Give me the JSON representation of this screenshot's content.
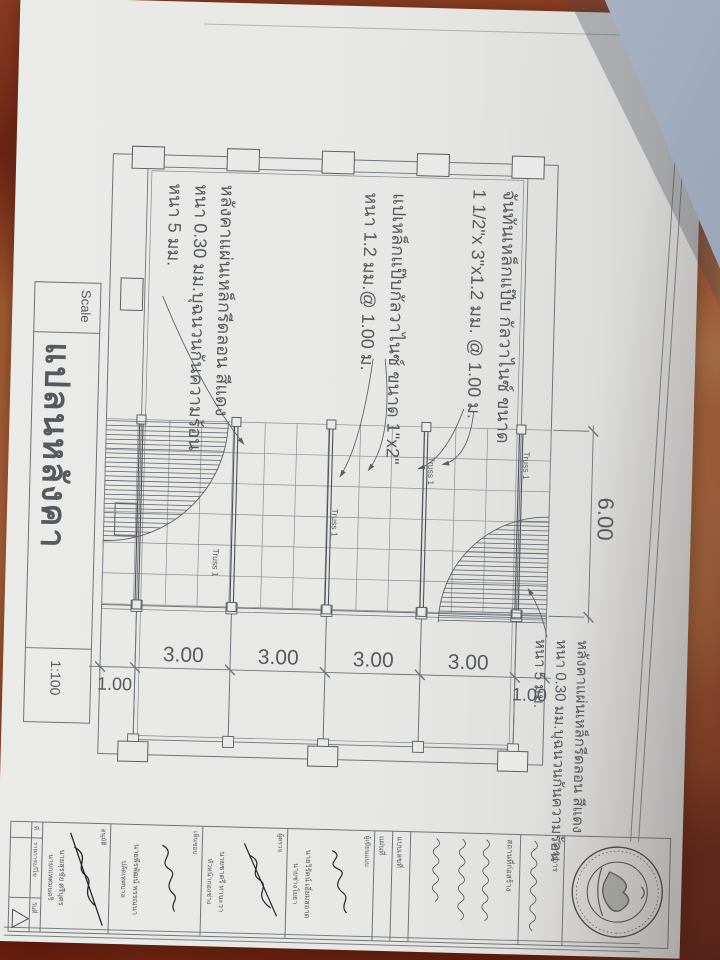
{
  "sheet": {
    "title": "แปลนหลังคา",
    "scale_label": "Scale",
    "scale_value": "1:100"
  },
  "plan": {
    "span_dim": "6.00",
    "bay_dims": [
      "3.00",
      "3.00",
      "3.00",
      "3.00"
    ],
    "overhang_start": "1.00",
    "overhang_end": "1.00",
    "truss_label": "Truss 1",
    "rafter_note": [
      "จันทันเหล็กแป๊บ กัลวาไนซ์ ขนาด",
      "1 1/2\"x 3\"x1.2 มม. @ 1.00 ม."
    ],
    "purlin_note": [
      "แปเหล็กแป๊บกัลวาไนซ์ ขนาด 1\"x2\"",
      "หนา 1.2 มม.@ 1.00 ม."
    ],
    "roof_note": [
      "หลังคาแผ่นเหล็กรีดลอน สีแดง",
      "หนา 0.30 มม.บุฉนวนกันความร้อน",
      "หนา 5 มม."
    ]
  },
  "title_block": {
    "project_label": "โครงการ",
    "site_label": "สถานที่ก่อสร้าง",
    "drawing_no_label": "แบบเลขที่",
    "sheet_no_label": "แผ่นที่",
    "revision_headers": [
      "ที่",
      "รายการแก้ไข",
      "วันที่"
    ],
    "rows": [
      {
        "label": "ผู้เขียนแบบ",
        "name": "นายวิรัตน์ เอี่ยมสอาด",
        "role": "นายช่างโยธา"
      },
      {
        "label": "ผู้ตรวจ",
        "name": "นายชาตรี ทานะวา",
        "role": "หัวหน้ากองช่าง"
      },
      {
        "label": "เห็นชอบ",
        "name": "นายพีรพัฒน์ พรรณนา",
        "role": "ปลัดเทศบาล"
      },
      {
        "label": "อนุมัติ",
        "name": "นายสุรชัย ศรีบุตร",
        "role": "นายกเทศมนตรี"
      }
    ]
  },
  "colors": {
    "paper": "#e9e9e7",
    "floor": "#a25a31",
    "line": "#6f7378",
    "blue_sheet": "#a9b3c5"
  }
}
